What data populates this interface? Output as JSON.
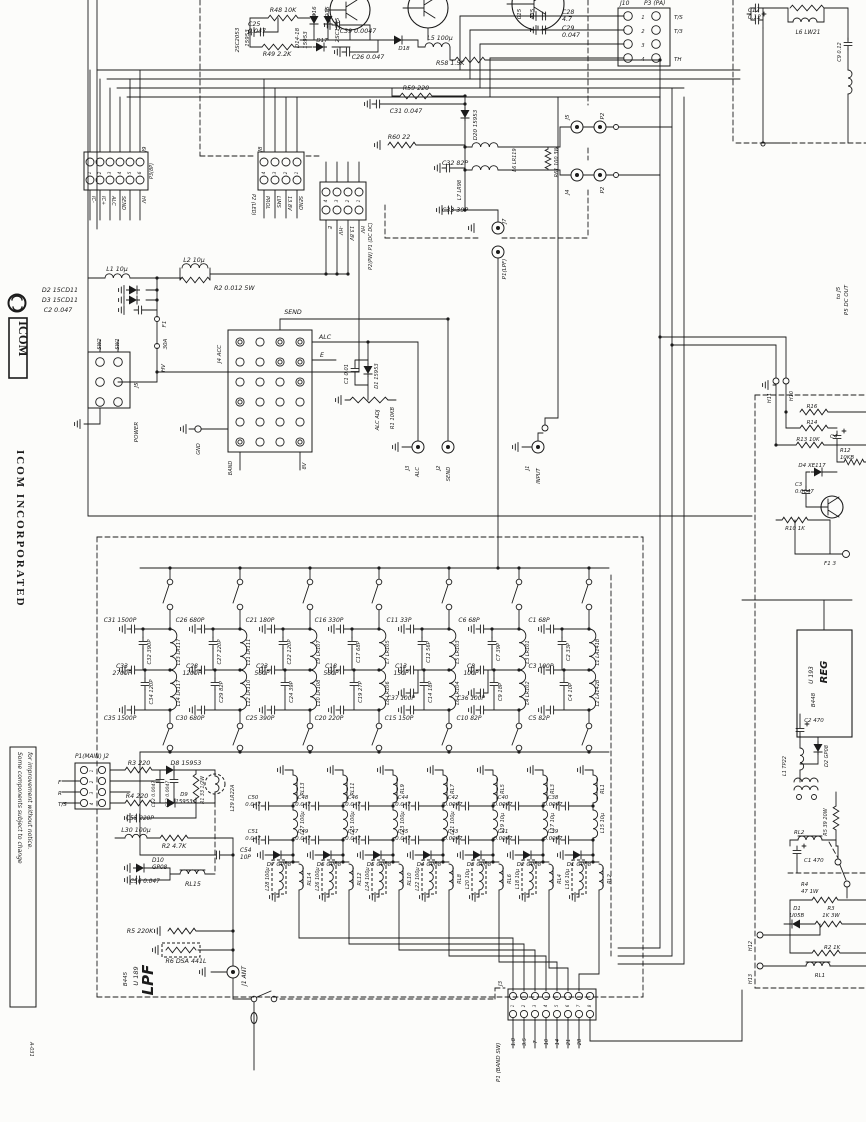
{
  "sheet": {
    "code": "A-031"
  },
  "brand": {
    "logo_text": "ICOM",
    "name": "ICOM  INCORPORATED",
    "note_line1": "Some components subject to change",
    "note_line2": "for improvement without notice."
  },
  "pa": {
    "q1": "2SC2053",
    "q1t": "15953",
    "r48": "R48 10K",
    "c25": "C25\n0.047",
    "r49": "R49 2.2K",
    "d_range": "D14-18",
    "d_type": "15953",
    "d16": "D16",
    "d15": "D15",
    "d17": "D17",
    "q2": "2SC1945",
    "c39": "C39 0.0047",
    "d18": "D18",
    "l5": "L5 100μ",
    "c26": "C26 0.047",
    "r58": "R58 1.5K",
    "c28": "C28\n4.7",
    "c29": "C29\n0.047",
    "f1": "015",
    "f2": "435",
    "r59": "R59 220",
    "c31": "C31 0.047",
    "d20": "D20 15953",
    "r60": "R60 22",
    "c32": "C32 82P",
    "l7": "L7 LR98",
    "l6": "L6 LR119",
    "r61": "R61 100 3W",
    "c33": "C33 39P",
    "j7": "J7",
    "p1": "P1(LPF)",
    "j5c": "J5",
    "p2a": "P2",
    "j4c": "J4",
    "p2b": "P2",
    "j10": "J10",
    "p3pa": "P3 (PA)",
    "j10pins": [
      "1",
      "2",
      "3",
      "4"
    ],
    "j10sig": [
      "T/S",
      "T/3",
      "",
      "TH"
    ]
  },
  "io": {
    "j9": {
      "j": "J9",
      "p": "P3(8P)",
      "pins": [
        "1",
        "2",
        "3",
        "4",
        "5",
        "6"
      ],
      "sig": [
        "IC-",
        "IC+",
        "ALC",
        "SEND",
        "",
        "HV"
      ]
    },
    "j8": {
      "j": "J8",
      "p": "P2 (LED)",
      "pins": [
        "4",
        "3",
        "2",
        "1"
      ],
      "sig": [
        "PROL",
        "LIMS",
        "13.8V",
        "SEND"
      ]
    },
    "p1dc": {
      "p": "P2(PW) P1 (DC DC)",
      "pins": [
        "4",
        "3",
        "2",
        "1"
      ],
      "sig": [
        "E",
        "-HV",
        "13.8V",
        "HV"
      ]
    }
  },
  "power": {
    "l1": "L1 10μ",
    "l2": "L2 10μ",
    "r2": "R2 0.012 5W",
    "d2": "D2 15CD11",
    "d3": "D3 15CD11",
    "c2": "C2 0.047",
    "f1": "F1",
    "f1a": "30A",
    "hv": "HV",
    "sw2": "SW2",
    "sw1": "SW1",
    "j5": "J5",
    "power": "POWER",
    "gnd": "GND"
  },
  "input": {
    "j4acc": "J4 ACC",
    "send": "SEND",
    "alc": "ALC",
    "e": "E",
    "band": "BAND",
    "v8": "8V",
    "c1": "C1 0.01",
    "d1": "D1 15953",
    "r1": "R1 10KB",
    "adj": "ALC ADJ",
    "j3": "J3",
    "alc2": "ALC",
    "j2": "J2",
    "send2": "SEND",
    "j1": "J1",
    "inp": "INPUT"
  },
  "lpf": {
    "main": {
      "conn": "P1(MAIN) J2",
      "pins": [
        "1",
        "2",
        "3",
        "4"
      ],
      "f": "F",
      "r": "R",
      "ts": "T/S"
    },
    "r3": "R3 220",
    "d8": "D8 15953",
    "c52": "C52 0.0047",
    "c53": "C53 0.0047",
    "r1": "R1 33 1/2W",
    "l29": "L29 LR22A",
    "r4": "R4 220",
    "d9": "D9\n15953",
    "c55": "C55 220P",
    "l30": "L30 100μ",
    "r2": "R2 4.7K",
    "c54": "C54\n10P",
    "d10": "D10\nGP08",
    "c56": "C56 0.047",
    "rl15": "RL15",
    "r5": "R5 220K",
    "r6": "R6  DSA 441L",
    "name": "LPF",
    "u": "U 189",
    "rev": "B445",
    "j1": "J1 ANT",
    "filters": [
      {
        "ct": "C31 1500P",
        "cm1": "C32 390P",
        "cc": "C33\n2700P",
        "cm2": "C34 120P",
        "cb": "C35 1500P",
        "lt": "L13 LR117",
        "lb": "L14 LR117"
      },
      {
        "ct": "C26 680P",
        "cm1": "C27 220P",
        "cc": "C28\n1200P",
        "cm2": "C29 82P",
        "cb": "C30 680P",
        "lt": "L11 LR111",
        "lb": "L12 LR110"
      },
      {
        "ct": "C21 180P",
        "cm1": "C22 120P",
        "cc": "C23\n560P",
        "cm2": "C24 39P",
        "cb": "C25 390P",
        "lt": "L9 LR107",
        "lb": "L10 LR108"
      },
      {
        "ct": "C16 330P",
        "cm1": "C17 68P",
        "cc": "C18\n560P",
        "cm2": "C19 27P",
        "cb": "C20 220P",
        "lt": "L7 LR105",
        "lb": "L8 LR106"
      },
      {
        "ct": "C11 33P",
        "cm1": "C12 56P",
        "cc": "C13\n150P",
        "cm2": "C14 18P",
        "cm3": "C37 100P",
        "cb": "C15 150P",
        "lt": "L5 LR103",
        "lb": "L6 LR104"
      },
      {
        "ct": "C6 68P",
        "cm1": "C7 39P",
        "cc": "C8\n100P",
        "cm2": "C9 18P",
        "cm3": "C36 100P",
        "cb": "C10 82P",
        "lt": "L3 LR101",
        "lb": "L4 LR102"
      },
      {
        "ct": "C1 68P",
        "cm1": "C2 33P",
        "cc": "C3 100P",
        "cm2": "C4 10P",
        "cb": "C5 82P",
        "lt": "L1 LA141B",
        "lb": "L2 LA142B"
      }
    ],
    "relays": [
      {
        "rt": "RL13",
        "lm": "L27 100μ",
        "c1": "C50\n0.047",
        "c2": "C51\n0.047",
        "d": "D7 GP08",
        "lb": "L28 100μ",
        "rb": "RL14"
      },
      {
        "rt": "RL11",
        "lm": "L25 100μ",
        "c1": "C48\n0.047",
        "c2": "C49\n0.047",
        "d": "D6 GP08",
        "lb": "L26 100μ",
        "rb": "RL12"
      },
      {
        "rt": "RL9",
        "lm": "L23 100μ",
        "c1": "C46\n0.047",
        "c2": "C47\n0.047",
        "d": "D5 GP08",
        "lb": "L24 100μ",
        "rb": "RL10"
      },
      {
        "rt": "RL7",
        "lm": "L21 100μ",
        "c1": "C44\n0.047",
        "c2": "C45\n0.047",
        "d": "D4 GP08",
        "lb": "L22 100μ",
        "rb": "RL8"
      },
      {
        "rt": "RL5",
        "lm": "L19 10μ",
        "c1": "C42\n0.0047",
        "c2": "C43\n0.0047",
        "d": "D3 GP08",
        "lb": "L20 10μ",
        "rb": "RL6"
      },
      {
        "rt": "RL3",
        "lm": "L17 10μ",
        "c1": "C40\n0.0047",
        "c2": "C41\n0.0047",
        "d": "D2 GP08",
        "lb": "L18 10μ",
        "rb": "RL4"
      },
      {
        "rt": "RL1",
        "lm": "L15 10μ",
        "c1": "C38\n0.0047",
        "c2": "C39\n0.0047",
        "d": "D1 GP08",
        "lb": "L16 10μ",
        "rb": "RL2"
      }
    ],
    "band": {
      "j": "J3",
      "p": "P1 (BAND SW)",
      "pins": [
        "1",
        "2",
        "3",
        "4",
        "5",
        "6",
        "7",
        "8"
      ],
      "bands": [
        "1.8",
        "3.5",
        "7",
        "10",
        "14",
        "21",
        "28"
      ]
    }
  },
  "dc": {
    "c12": "C12\n0.12",
    "l6": "L6 LW21",
    "c9": "C9 0.12",
    "p5": "P5 DC OUT",
    "toj5": "to J5",
    "h10": "H10",
    "h11": "H11",
    "r16": "R16",
    "r14": "R14",
    "c4": "C4",
    "r13": "R13 10K",
    "r12": "R12\n10KB",
    "d4": "D4 XE117",
    "c3": "C3\n0.0047",
    "r10": "R10 1K",
    "f1": "F1 3",
    "reg": "REG",
    "u": "U 193",
    "rev": "B448",
    "c2": "C2  470",
    "d2": "D2 GP08",
    "l1": "L1 TP22",
    "rl2": "RL2",
    "c1": "C1 470",
    "r5": "R5 39 20W",
    "r4": "R4\n47 1W",
    "d1": "D1\nU05B",
    "r3": "R3\n1K 3W",
    "r2": "R2 1K",
    "rl1": "RL1",
    "h12": "H12",
    "h13": "H13"
  }
}
